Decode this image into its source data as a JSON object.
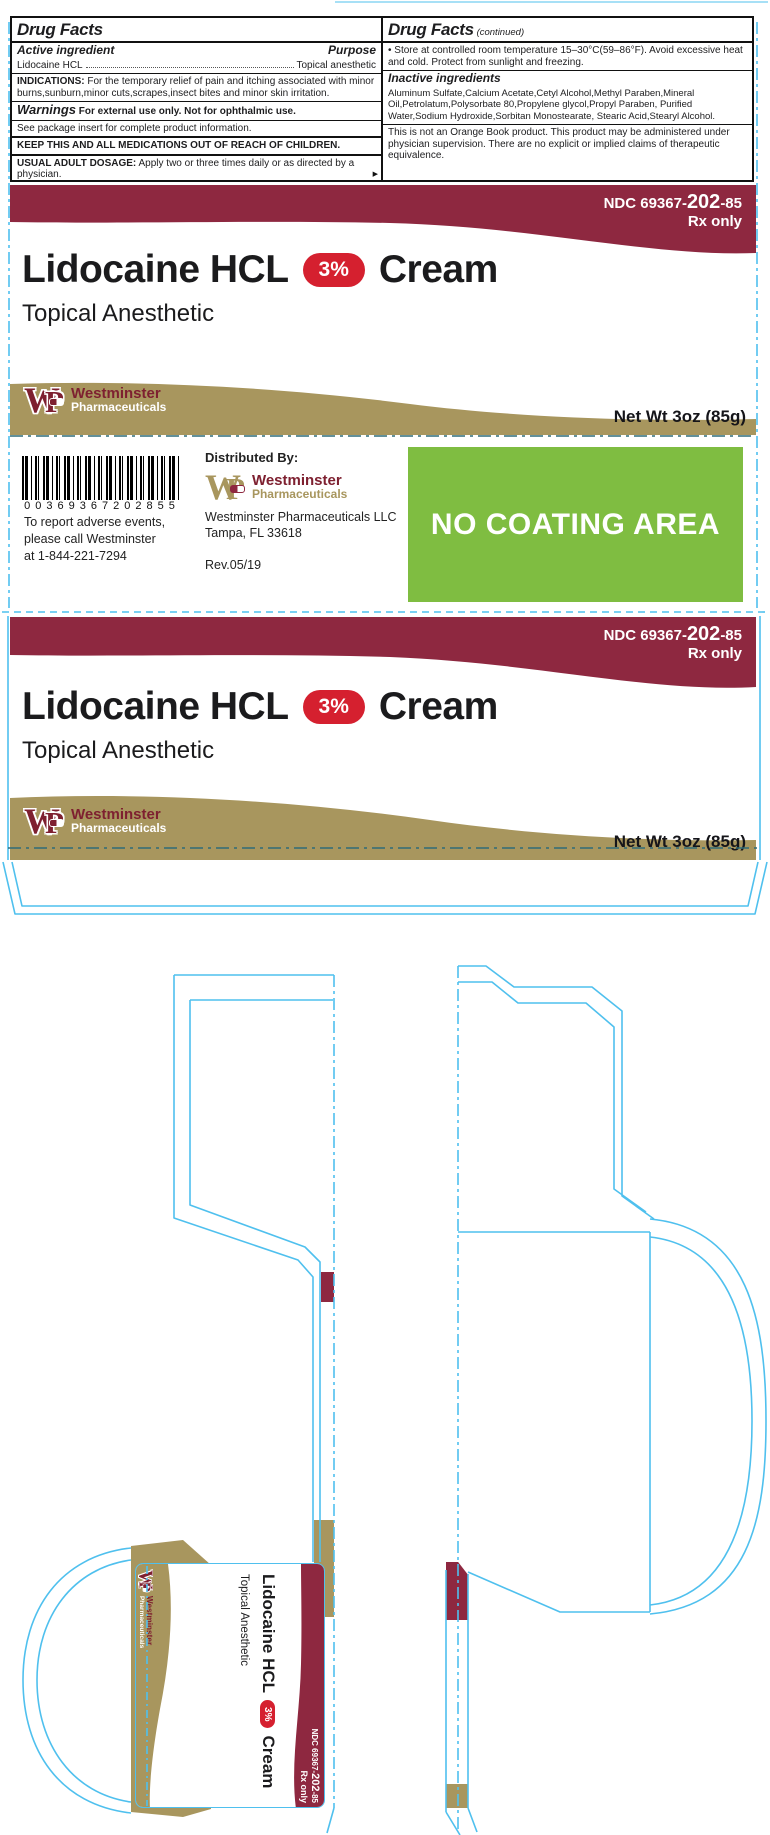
{
  "colors": {
    "maroon": "#8E2840",
    "logo_maroon": "#7E2030",
    "gold": "#A8965E",
    "red_pill": "#D5202F",
    "green": "#7FBD41",
    "dieline_cyan": "#4FC0EE",
    "fold_teal": "#2F6B78"
  },
  "drug_facts": {
    "title": "Drug Facts",
    "continued_suffix": "(continued)",
    "active_ingredient_label": "Active ingredient",
    "purpose_label": "Purpose",
    "active_ingredient_name": "Lidocaine HCL",
    "purpose_value": "Topical anesthetic",
    "indications_label": "INDICATIONS:",
    "indications_text": "For the temporary relief of pain and itching associated with minor burns,sunburn,minor cuts,scrapes,insect bites and minor skin irritation.",
    "warnings_label": "Warnings",
    "warnings_text": "For external use only. Not for ophthalmic use.",
    "insert_note": "See package insert for complete product information.",
    "keep_away": "KEEP THIS AND ALL MEDICATIONS OUT OF REACH OF CHILDREN.",
    "dosage_label": "USUAL ADULT DOSAGE:",
    "dosage_text": "Apply two or three times daily or as directed by a physician.",
    "storage_text": "• Store at controlled room temperature 15–30°C(59–86°F). Avoid excessive heat and cold. Protect from sunlight and freezing.",
    "inactive_label": "Inactive ingredients",
    "inactive_text": "Aluminum Sulfate,Calcium Acetate,Cetyl Alcohol,Methyl Paraben,Mineral Oil,Petrolatum,Polysorbate 80,Propylene glycol,Propyl Paraben, Purified Water,Sodium Hydroxide,Sorbitan Monostearate, Stearic Acid,Stearyl Alcohol.",
    "orange_book_text": "This is not an Orange Book product. This product may be administered under physician supervision. There are no explicit or implied claims of therapeutic equivalence."
  },
  "panel": {
    "ndc_prefix": "NDC 69367-",
    "ndc_bold": "202",
    "ndc_suffix": "-85",
    "rx_only": "Rx only",
    "title": "Lidocaine HCL",
    "strength": "3%",
    "form": "Cream",
    "subtitle": "Topical Anesthetic",
    "net_wt": "Net Wt 3oz (85g)"
  },
  "brand": {
    "monogram_w": "W",
    "monogram_p": "P",
    "name": "Westminster",
    "division": "Pharmaceuticals"
  },
  "middle": {
    "barcode_digits": "00369367202855",
    "adverse_lines": [
      "To report adverse events,",
      "please call Westminster",
      "at 1-844-221-7294"
    ],
    "distributed_by": "Distributed By:",
    "company": "Westminster Pharmaceuticals LLC",
    "city": "Tampa, FL 33618",
    "rev": "Rev.05/19",
    "no_coating": "NO COATING AREA"
  },
  "icons": {
    "more_arrow": "▶"
  }
}
